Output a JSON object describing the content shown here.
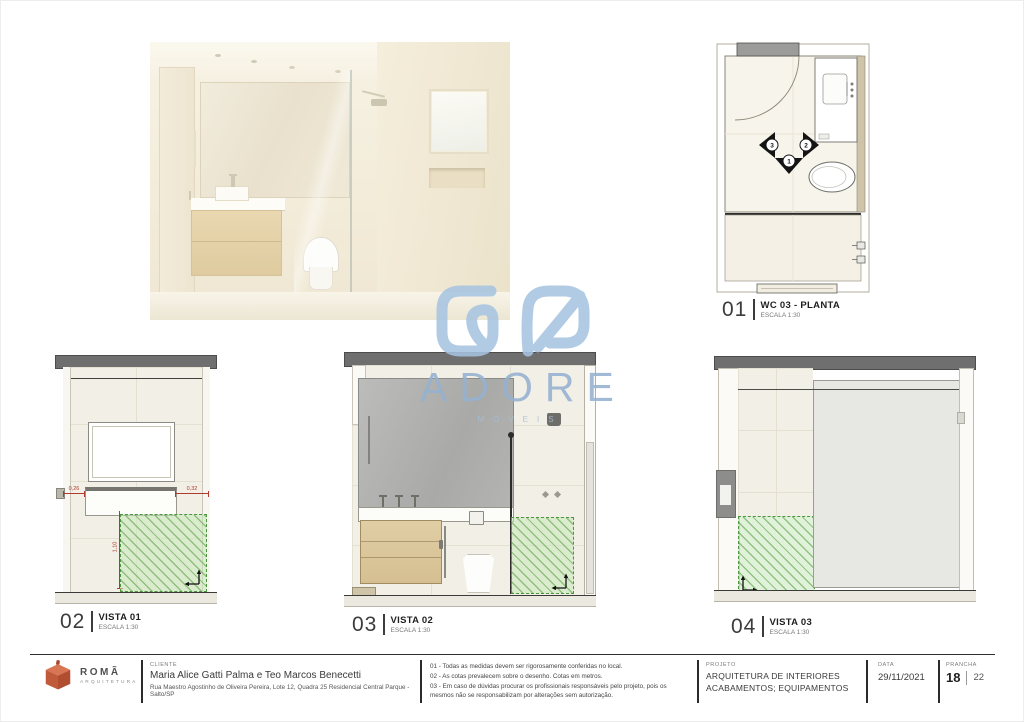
{
  "views": [
    {
      "number": "01",
      "title": "WC 03 - PLANTA",
      "scale": "ESCALA 1:30"
    },
    {
      "number": "02",
      "title": "VISTA 01",
      "scale": "ESCALA 1:30"
    },
    {
      "number": "03",
      "title": "VISTA 02",
      "scale": "ESCALA 1:30"
    },
    {
      "number": "04",
      "title": "VISTA 03",
      "scale": "ESCALA 1:30"
    }
  ],
  "plan": {
    "markers": [
      "1",
      "2",
      "3"
    ]
  },
  "vista01_dims": {
    "left": "0,26",
    "right": "0,32",
    "height": "1,10"
  },
  "watermark": {
    "brand": "ADORE",
    "subtitle": "MÓVEIS"
  },
  "titleblock": {
    "logo": {
      "name": "ROMÃ",
      "subtitle": "ARQUITETURA"
    },
    "cliente": {
      "label": "CLIENTE",
      "name": "Maria Alice Gatti Palma e Teo Marcos Benecetti",
      "address": "Rua Maestro Agostinho de Oliveira Pereira, Lote 12, Quadra 25 Residencial Central Parque - Salto/SP"
    },
    "notes": [
      "01 - Todas as medidas devem ser rigorosamente conferidas no local.",
      "02 - As cotas prevalecem sobre o desenho. Cotas em metros.",
      "03 - Em caso de dúvidas procurar os profissionais responsáveis pelo projeto, pois os mesmos não se responsabilizam por alterações sem autorização."
    ],
    "projeto": {
      "label": "PROJETO",
      "line1": "ARQUITETURA DE INTERIORES",
      "line2": "ACABAMENTOS; EQUIPAMENTOS"
    },
    "data": {
      "label": "DATA",
      "value": "29/11/2021"
    },
    "prancha": {
      "label": "PRANCHA",
      "current": "18",
      "total": "22"
    }
  },
  "colors": {
    "accent_orange": "#c05c3a",
    "watermark_blue": "#9fc0dc",
    "hatch_green": "#4e9442",
    "dimension_red": "#b03a2e",
    "band_gray": "#6f6f6f"
  }
}
